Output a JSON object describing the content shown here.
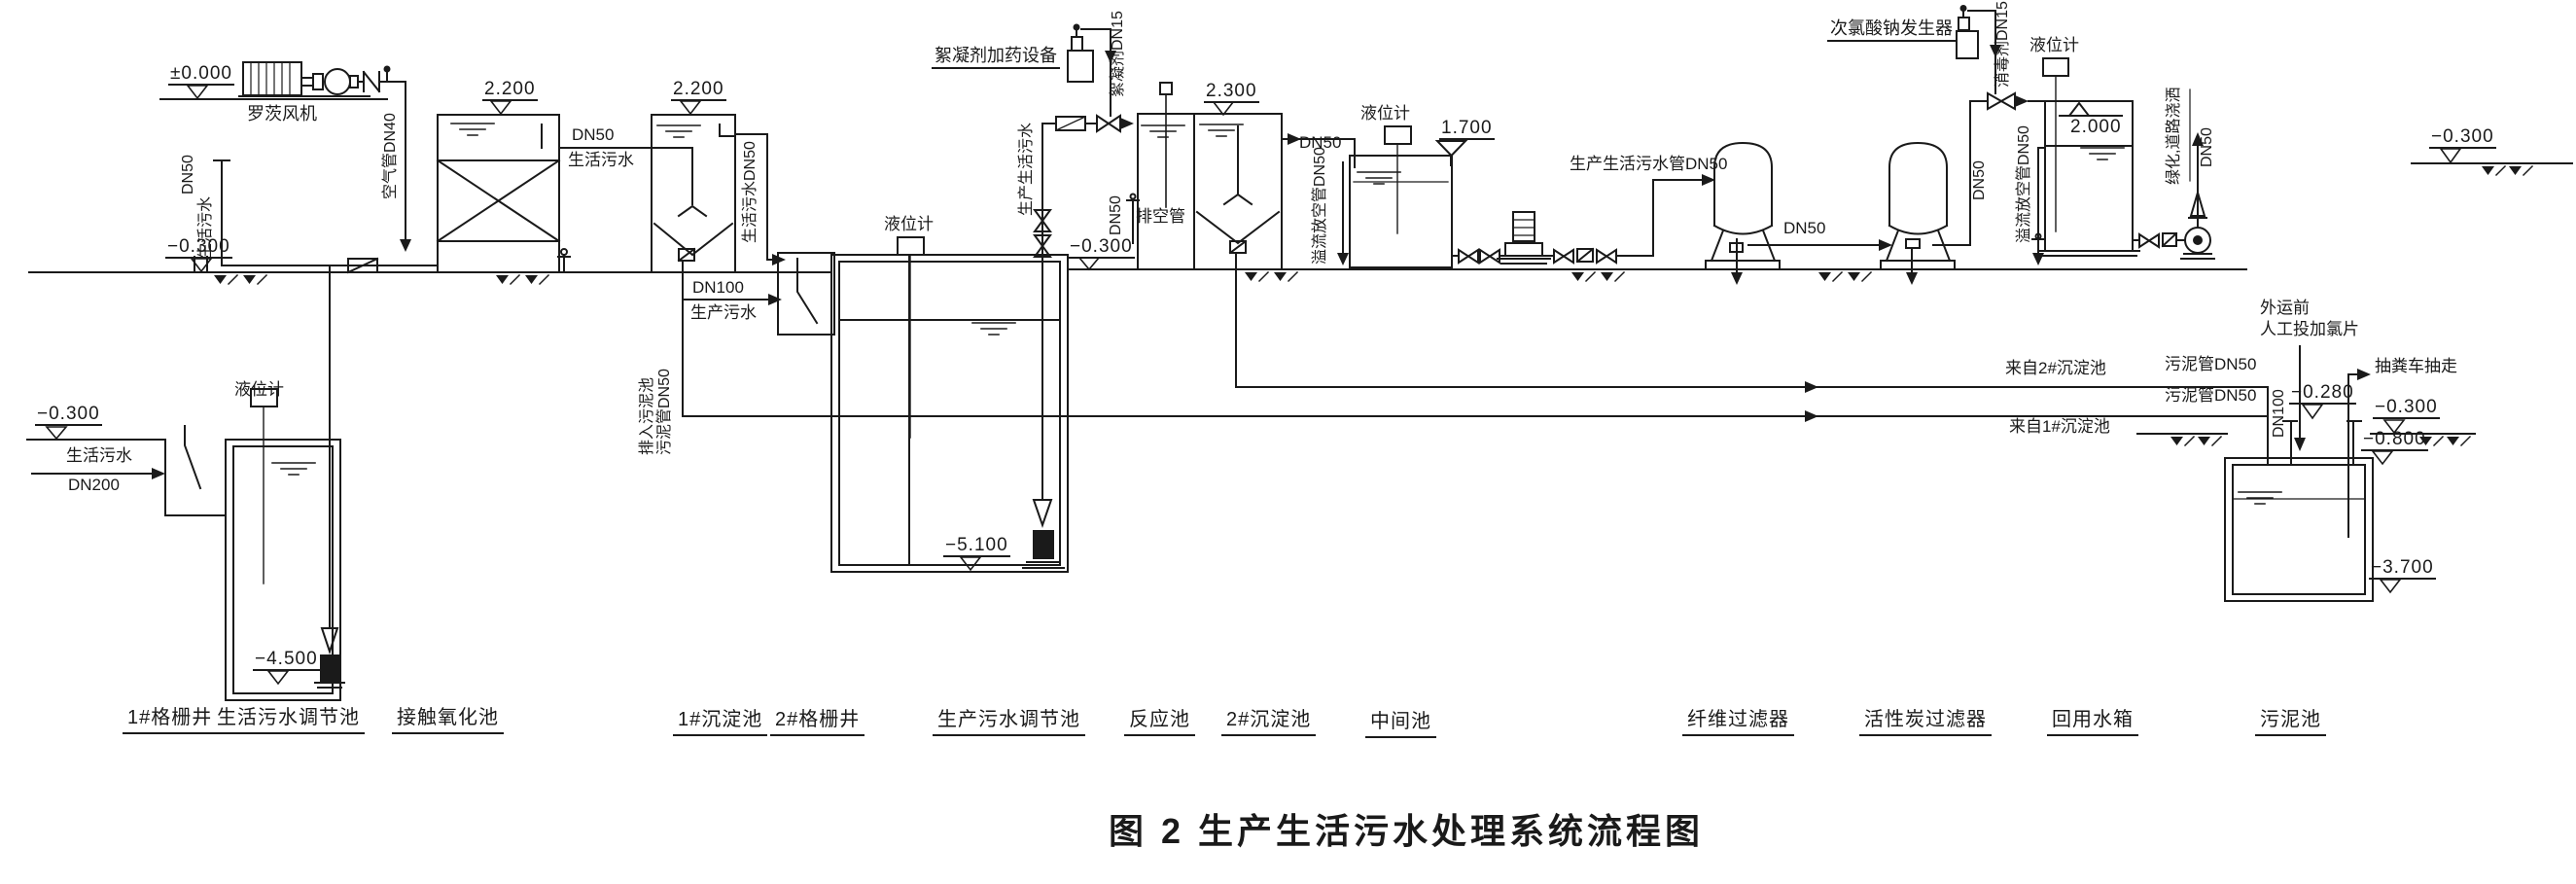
{
  "figure_title": "图 2  生产生活污水处理系统流程图",
  "units": {
    "grit_well_1": "1#格栅井",
    "domestic_regulating_tank": "生活污水调节池",
    "contact_oxidation_tank": "接触氧化池",
    "sedimentation_tank_1": "1#沉淀池",
    "grit_well_2": "2#格栅井",
    "production_regulating_tank": "生产污水调节池",
    "reaction_tank": "反应池",
    "sedimentation_tank_2": "2#沉淀池",
    "middle_tank": "中间池",
    "fiber_filter": "纤维过滤器",
    "carbon_filter": "活性炭过滤器",
    "reuse_water_tank": "回用水箱",
    "sludge_tank": "污泥池"
  },
  "equipment": {
    "roots_blower": "罗茨风机",
    "flocculant_dosing_device": "絮凝剂加药设备",
    "hypochlorite_generator": "次氯酸钠发生器",
    "level_gauge": "液位计"
  },
  "elevations": {
    "zero": "±0.000",
    "neg_0_300": "−0.300",
    "pos_2_200": "2.200",
    "pos_2_300": "2.300",
    "pos_1_700": "1.700",
    "pos_2_000": "2.000",
    "neg_0_280": "−0.280",
    "neg_0_800": "−0.800",
    "neg_3_700": "−3.700",
    "neg_4_500": "−4.500",
    "neg_5_100": "−5.100"
  },
  "pipes": {
    "air_dn40": "空气管DN40",
    "dn50": "DN50",
    "dn100": "DN100",
    "dn200": "DN200",
    "domestic_sewage": "生活污水",
    "production_sewage": "生产污水",
    "domestic_dn50": "生活污水DN50",
    "prod_dom_sewage": "生产生活污水",
    "prod_dom_dn50": "生产生活污水管DN50",
    "flocculant_dn15": "絮凝剂DN15",
    "disinfectant_dn15": "消毒剂DN15",
    "drain_pipe": "排空管",
    "overflow_drain_dn50": "溢流放空管DN50",
    "sludge_pipe_dn50": "污泥管DN50",
    "to_sludge_tank": "排入污泥池",
    "greening_spray": "绿化,道路浇洒"
  },
  "annotations": {
    "from_sed_2": "来自2#沉淀池",
    "from_sed_1": "来自1#沉淀池",
    "truck_removal": "抽粪车抽走",
    "pre_transport": "外运前",
    "manual_chlorine": "人工投加氯片"
  }
}
